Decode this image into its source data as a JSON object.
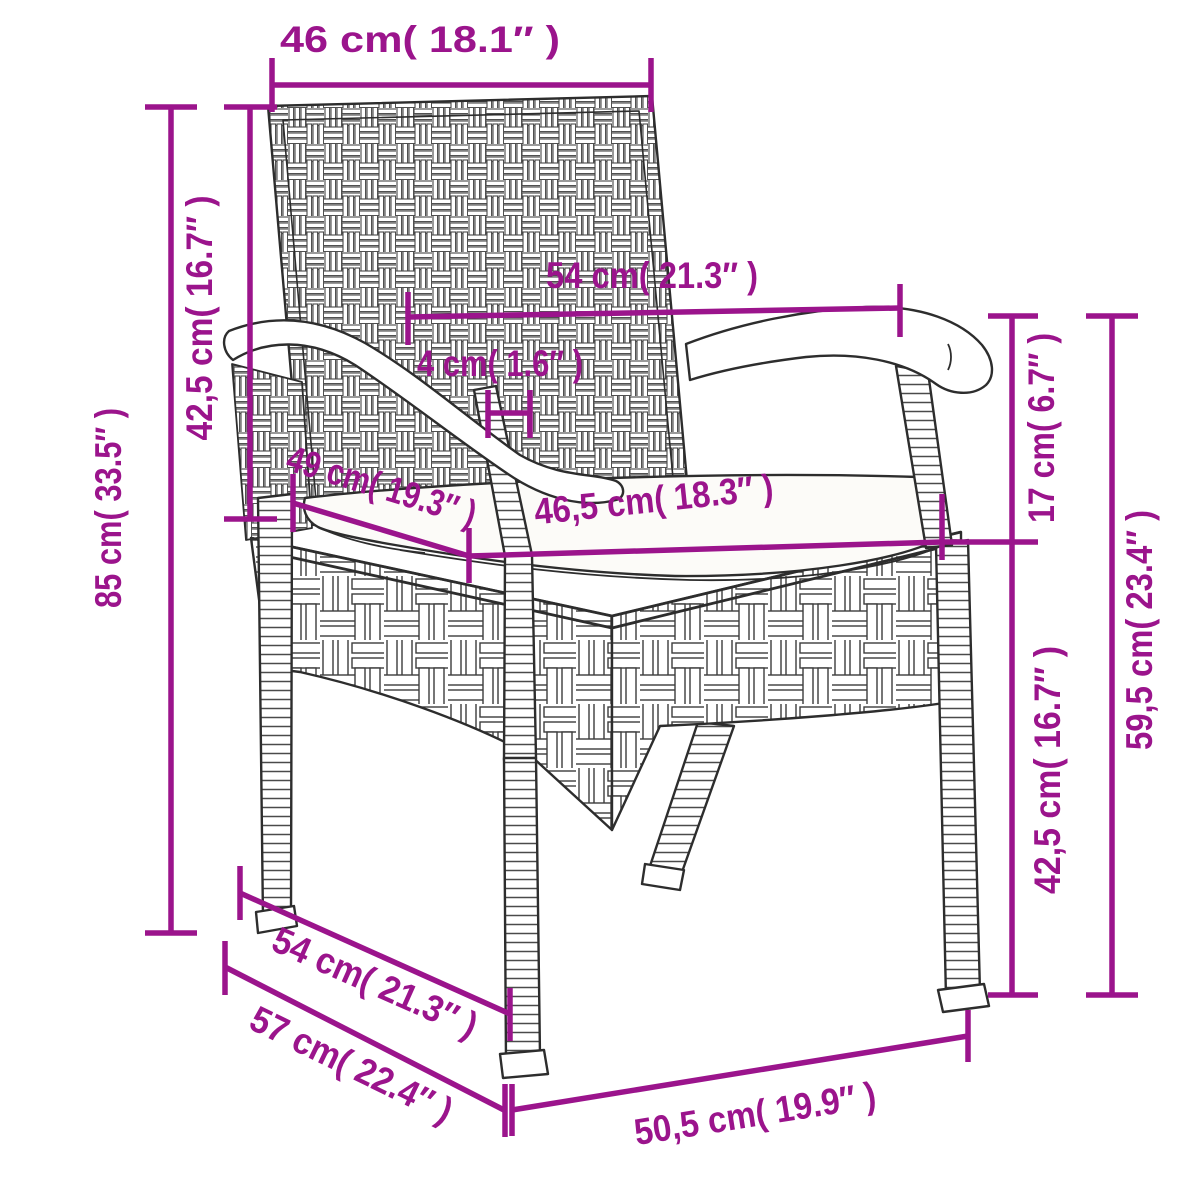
{
  "diagram": {
    "kind": "product-dimension-diagram",
    "subject": "poly rattan garden chair with seat cushion",
    "accent_color": "#9b148c",
    "line_color": "#2d2d2d",
    "background_color": "#ffffff"
  },
  "dimensions": {
    "backrest_width": "46 cm( 18.1″ )",
    "backrest_height": "42,5 cm( 16.7″ )",
    "total_height": "85 cm( 33.5″ )",
    "armrest_span": "54 cm( 21.3″ )",
    "pole_thickness": "4 cm( 1.6″ )",
    "seat_depth": "49 cm( 19.3″ )",
    "seat_width": "46,5 cm( 18.3″ )",
    "seat_to_armrest_height": "17 cm( 6.7″ )",
    "armrest_height": "59,5 cm( 23.4″ )",
    "seat_height": "42,5 cm( 16.7″ )",
    "base_depth": "54 cm( 21.3″ )",
    "overall_depth": "57 cm( 22.4″ )",
    "base_width": "50,5 cm( 19.9″ )"
  }
}
